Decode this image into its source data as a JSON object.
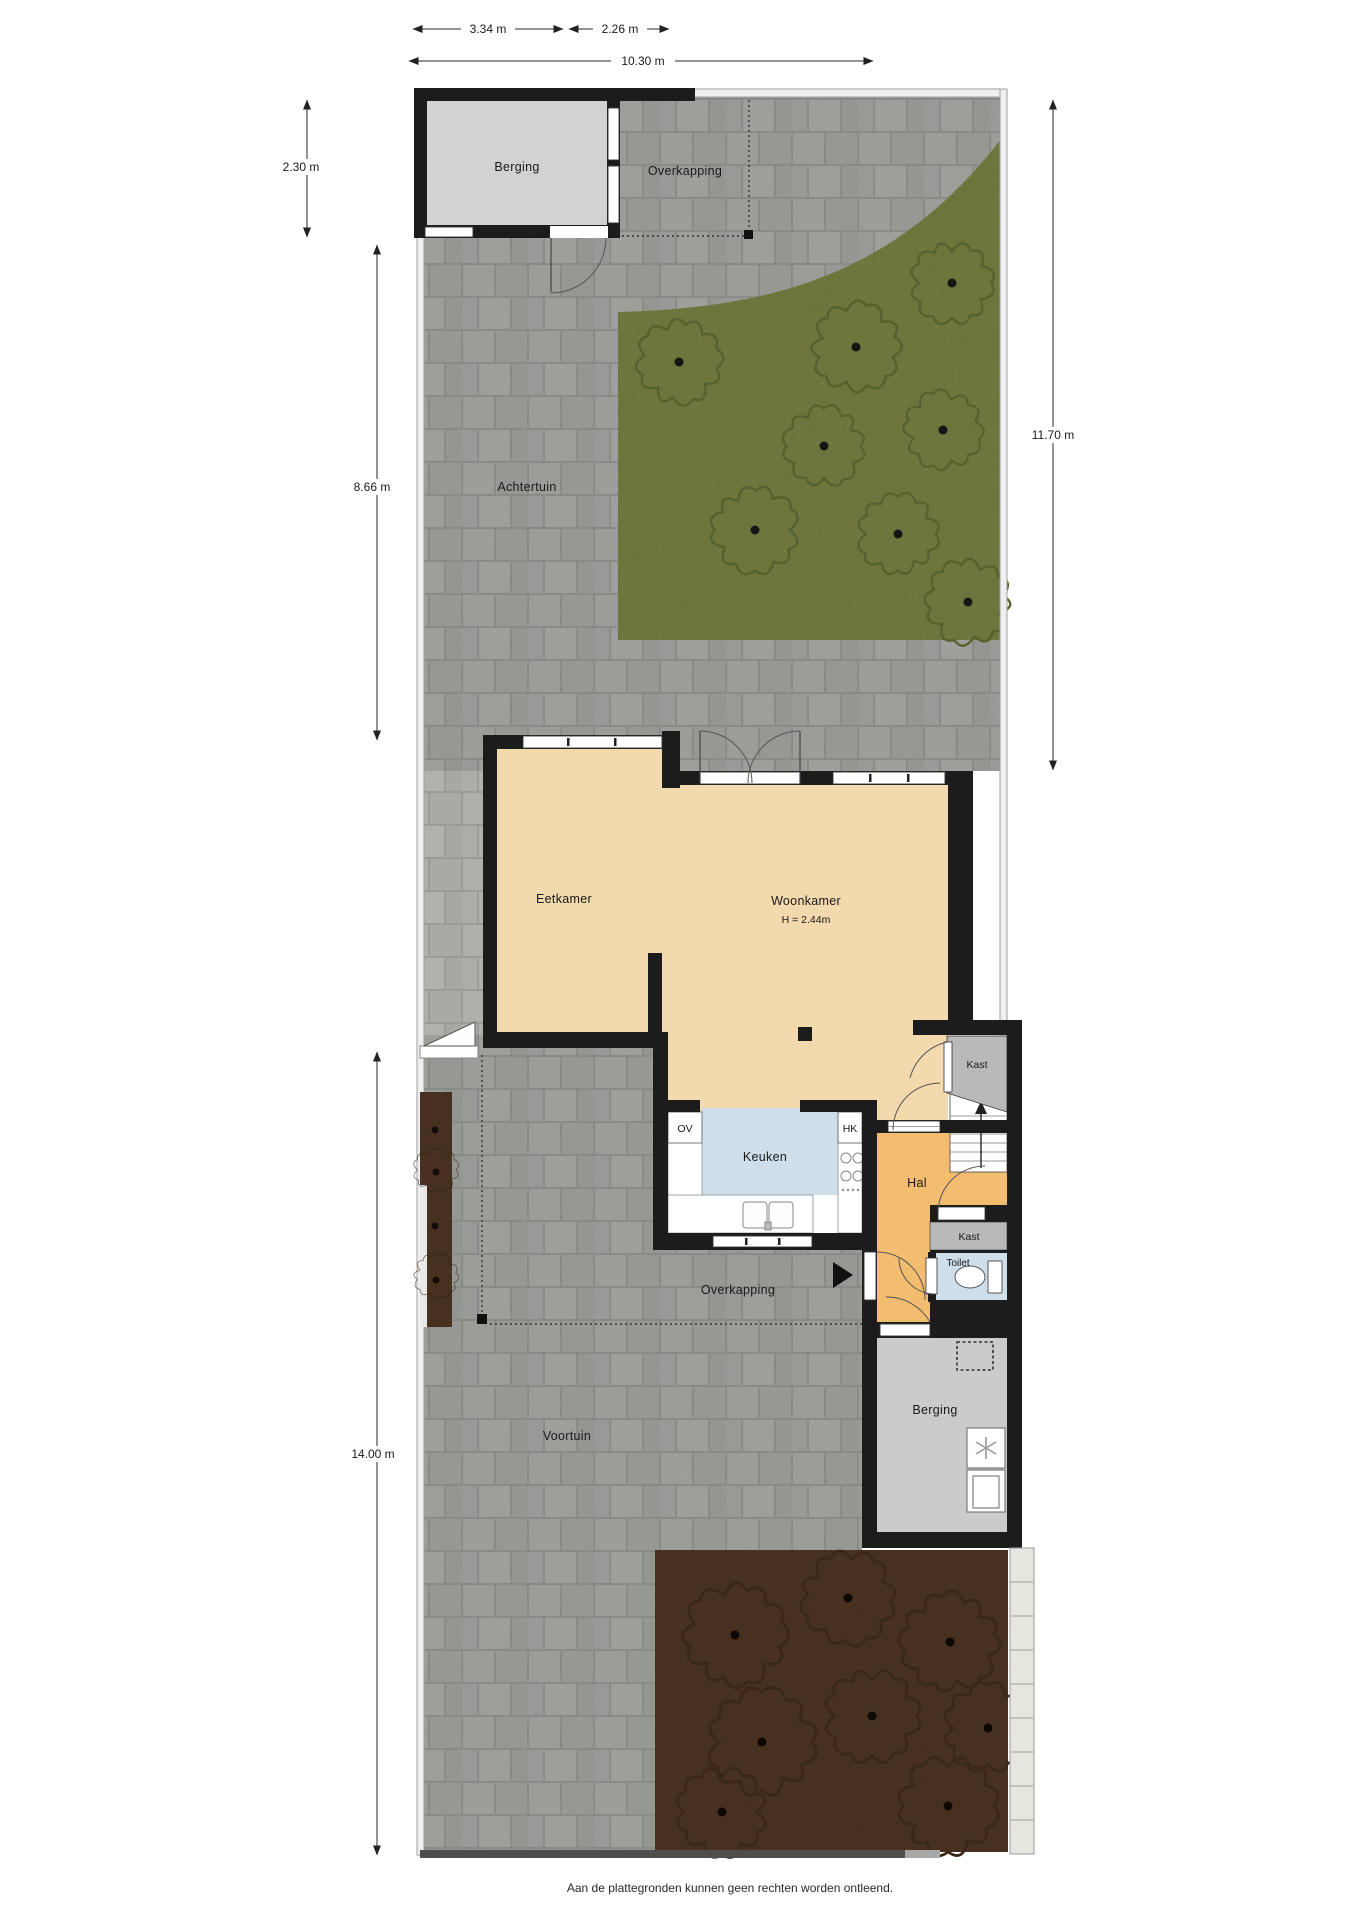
{
  "plan_title": "Begane grond met tuin",
  "rooms": {
    "berging_top": "Berging",
    "overkapping_top": "Overkapping",
    "achtertuin": "Achtertuin",
    "eetkamer": "Eetkamer",
    "woonkamer": "Woonkamer",
    "woonkamer_ceiling": "H = 2.44m",
    "keuken": "Keuken",
    "oven": "OV",
    "hk": "HK",
    "hal": "Hal",
    "kast_boven": "Kast",
    "kast_onder": "Kast",
    "toilet": "Toilet",
    "berging_onder": "Berging",
    "overkapping_onder": "Overkapping",
    "voortuin": "Voortuin"
  },
  "dimensions": {
    "top_left": "3.34 m",
    "top_right": "2.26 m",
    "top_total": "10.30 m",
    "side_berging": "2.30 m",
    "side_achtertuin": "8.66 m",
    "side_voortuin": "14.00 m",
    "side_right": "11.70 m"
  },
  "footer": {
    "disclaimer": "Aan de plattegronden kunnen geen rechten worden ontleend."
  },
  "colors": {
    "wall": "#1c1c1c",
    "floor_living": "#f3d9ae",
    "floor_hal": "#f2bd6e",
    "floor_kitchen": "#cfdeeb",
    "floor_storage": "#d2d2d2",
    "floor_closet": "#b9b9b9",
    "paving": "#aaaca8",
    "grass": "#98a455",
    "soil": "#6e4b31"
  }
}
